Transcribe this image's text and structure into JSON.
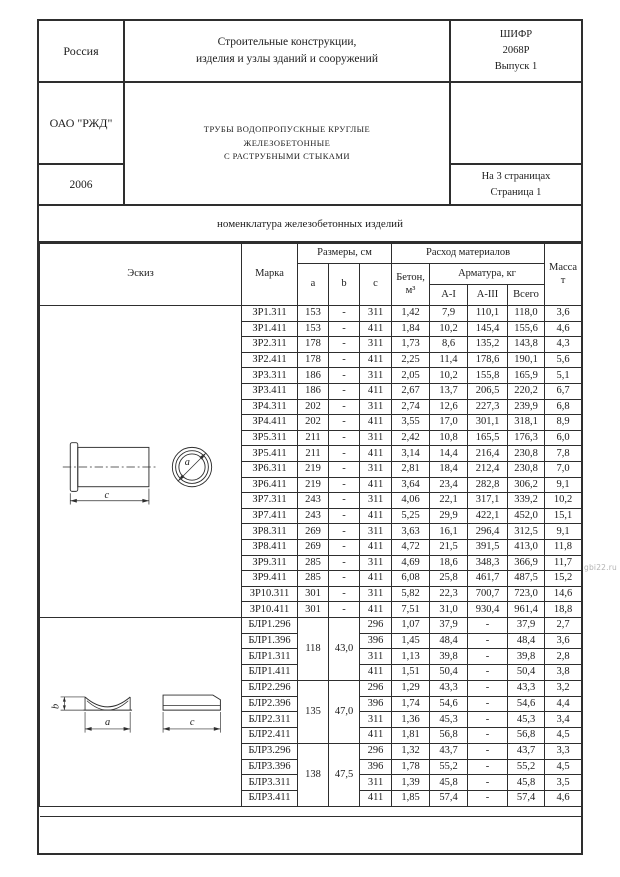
{
  "page": {
    "watermark": "gbi22.ru"
  },
  "header": {
    "country": "Россия",
    "organization": "ОАО \"РЖД\"",
    "year": "2006",
    "series": "Строительные конструкции,\nизделия и узлы зданий и сооружений",
    "title": "ТРУБЫ ВОДОПРОПУСКНЫЕ КРУГЛЫЕ\nЖЕЛЕЗОБЕТОННЫЕ\nС РАСТРУБНЫМИ СТЫКАМИ",
    "cipher": "ШИФР\n2068Р\nВыпуск 1",
    "pages": "На 3 страницах\nСтраница 1"
  },
  "band": {
    "title": "номенклатура железобетонных изделий"
  },
  "table": {
    "headers": {
      "sketch": "Эскиз",
      "mark": "Марка",
      "dimensions": "Размеры, см",
      "dim_a": "a",
      "dim_b": "b",
      "dim_c": "c",
      "materials": "Расход материалов",
      "concrete": "Бетон,\nм³",
      "rebar": "Арматура, кг",
      "rebar_ai": "А-I",
      "rebar_aiii": "А-III",
      "rebar_total": "Всего",
      "mass": "Масса\nт"
    },
    "zr_rows": [
      {
        "mark": "ЗР1.311",
        "a": "153",
        "b": "-",
        "c": "311",
        "concrete": "1,42",
        "ai": "7,9",
        "aiii": "110,1",
        "total": "118,0",
        "mass": "3,6"
      },
      {
        "mark": "ЗР1.411",
        "a": "153",
        "b": "-",
        "c": "411",
        "concrete": "1,84",
        "ai": "10,2",
        "aiii": "145,4",
        "total": "155,6",
        "mass": "4,6"
      },
      {
        "mark": "ЗР2.311",
        "a": "178",
        "b": "-",
        "c": "311",
        "concrete": "1,73",
        "ai": "8,6",
        "aiii": "135,2",
        "total": "143,8",
        "mass": "4,3"
      },
      {
        "mark": "ЗР2.411",
        "a": "178",
        "b": "-",
        "c": "411",
        "concrete": "2,25",
        "ai": "11,4",
        "aiii": "178,6",
        "total": "190,1",
        "mass": "5,6"
      },
      {
        "mark": "ЗР3.311",
        "a": "186",
        "b": "-",
        "c": "311",
        "concrete": "2,05",
        "ai": "10,2",
        "aiii": "155,8",
        "total": "165,9",
        "mass": "5,1"
      },
      {
        "mark": "ЗР3.411",
        "a": "186",
        "b": "-",
        "c": "411",
        "concrete": "2,67",
        "ai": "13,7",
        "aiii": "206,5",
        "total": "220,2",
        "mass": "6,7"
      },
      {
        "mark": "ЗР4.311",
        "a": "202",
        "b": "-",
        "c": "311",
        "concrete": "2,74",
        "ai": "12,6",
        "aiii": "227,3",
        "total": "239,9",
        "mass": "6,8"
      },
      {
        "mark": "ЗР4.411",
        "a": "202",
        "b": "-",
        "c": "411",
        "concrete": "3,55",
        "ai": "17,0",
        "aiii": "301,1",
        "total": "318,1",
        "mass": "8,9"
      },
      {
        "mark": "ЗР5.311",
        "a": "211",
        "b": "-",
        "c": "311",
        "concrete": "2,42",
        "ai": "10,8",
        "aiii": "165,5",
        "total": "176,3",
        "mass": "6,0"
      },
      {
        "mark": "ЗР5.411",
        "a": "211",
        "b": "-",
        "c": "411",
        "concrete": "3,14",
        "ai": "14,4",
        "aiii": "216,4",
        "total": "230,8",
        "mass": "7,8"
      },
      {
        "mark": "ЗР6.311",
        "a": "219",
        "b": "-",
        "c": "311",
        "concrete": "2,81",
        "ai": "18,4",
        "aiii": "212,4",
        "total": "230,8",
        "mass": "7,0"
      },
      {
        "mark": "ЗР6.411",
        "a": "219",
        "b": "-",
        "c": "411",
        "concrete": "3,64",
        "ai": "23,4",
        "aiii": "282,8",
        "total": "306,2",
        "mass": "9,1"
      },
      {
        "mark": "ЗР7.311",
        "a": "243",
        "b": "-",
        "c": "311",
        "concrete": "4,06",
        "ai": "22,1",
        "aiii": "317,1",
        "total": "339,2",
        "mass": "10,2"
      },
      {
        "mark": "ЗР7.411",
        "a": "243",
        "b": "-",
        "c": "411",
        "concrete": "5,25",
        "ai": "29,9",
        "aiii": "422,1",
        "total": "452,0",
        "mass": "15,1"
      },
      {
        "mark": "ЗР8.311",
        "a": "269",
        "b": "-",
        "c": "311",
        "concrete": "3,63",
        "ai": "16,1",
        "aiii": "296,4",
        "total": "312,5",
        "mass": "9,1"
      },
      {
        "mark": "ЗР8.411",
        "a": "269",
        "b": "-",
        "c": "411",
        "concrete": "4,72",
        "ai": "21,5",
        "aiii": "391,5",
        "total": "413,0",
        "mass": "11,8"
      },
      {
        "mark": "ЗР9.311",
        "a": "285",
        "b": "-",
        "c": "311",
        "concrete": "4,69",
        "ai": "18,6",
        "aiii": "348,3",
        "total": "366,9",
        "mass": "11,7"
      },
      {
        "mark": "ЗР9.411",
        "a": "285",
        "b": "-",
        "c": "411",
        "concrete": "6,08",
        "ai": "25,8",
        "aiii": "461,7",
        "total": "487,5",
        "mass": "15,2"
      },
      {
        "mark": "ЗР10.311",
        "a": "301",
        "b": "-",
        "c": "311",
        "concrete": "5,82",
        "ai": "22,3",
        "aiii": "700,7",
        "total": "723,0",
        "mass": "14,6"
      },
      {
        "mark": "ЗР10.411",
        "a": "301",
        "b": "-",
        "c": "411",
        "concrete": "7,51",
        "ai": "31,0",
        "aiii": "930,4",
        "total": "961,4",
        "mass": "18,8"
      }
    ],
    "blr_groups": [
      {
        "a": "118",
        "b": "43,0",
        "rows": [
          {
            "mark": "БЛР1.296",
            "c": "296",
            "concrete": "1,07",
            "ai": "37,9",
            "aiii": "-",
            "total": "37,9",
            "mass": "2,7"
          },
          {
            "mark": "БЛР1.396",
            "c": "396",
            "concrete": "1,45",
            "ai": "48,4",
            "aiii": "-",
            "total": "48,4",
            "mass": "3,6"
          },
          {
            "mark": "БЛР1.311",
            "c": "311",
            "concrete": "1,13",
            "ai": "39,8",
            "aiii": "-",
            "total": "39,8",
            "mass": "2,8"
          },
          {
            "mark": "БЛР1.411",
            "c": "411",
            "concrete": "1,51",
            "ai": "50,4",
            "aiii": "-",
            "total": "50,4",
            "mass": "3,8"
          }
        ]
      },
      {
        "a": "135",
        "b": "47,0",
        "rows": [
          {
            "mark": "БЛР2.296",
            "c": "296",
            "concrete": "1,29",
            "ai": "43,3",
            "aiii": "-",
            "total": "43,3",
            "mass": "3,2"
          },
          {
            "mark": "БЛР2.396",
            "c": "396",
            "concrete": "1,74",
            "ai": "54,6",
            "aiii": "-",
            "total": "54,6",
            "mass": "4,4"
          },
          {
            "mark": "БЛР2.311",
            "c": "311",
            "concrete": "1,36",
            "ai": "45,3",
            "aiii": "-",
            "total": "45,3",
            "mass": "3,4"
          },
          {
            "mark": "БЛР2.411",
            "c": "411",
            "concrete": "1,81",
            "ai": "56,8",
            "aiii": "-",
            "total": "56,8",
            "mass": "4,5"
          }
        ]
      },
      {
        "a": "138",
        "b": "47,5",
        "rows": [
          {
            "mark": "БЛР3.296",
            "c": "296",
            "concrete": "1,32",
            "ai": "43,7",
            "aiii": "-",
            "total": "43,7",
            "mass": "3,3"
          },
          {
            "mark": "БЛР3.396",
            "c": "396",
            "concrete": "1,78",
            "ai": "55,2",
            "aiii": "-",
            "total": "55,2",
            "mass": "4,5"
          },
          {
            "mark": "БЛР3.311",
            "c": "311",
            "concrete": "1,39",
            "ai": "45,8",
            "aiii": "-",
            "total": "45,8",
            "mass": "3,5"
          },
          {
            "mark": "БЛР3.411",
            "c": "411",
            "concrete": "1,85",
            "ai": "57,4",
            "aiii": "-",
            "total": "57,4",
            "mass": "4,6"
          }
        ]
      }
    ]
  }
}
